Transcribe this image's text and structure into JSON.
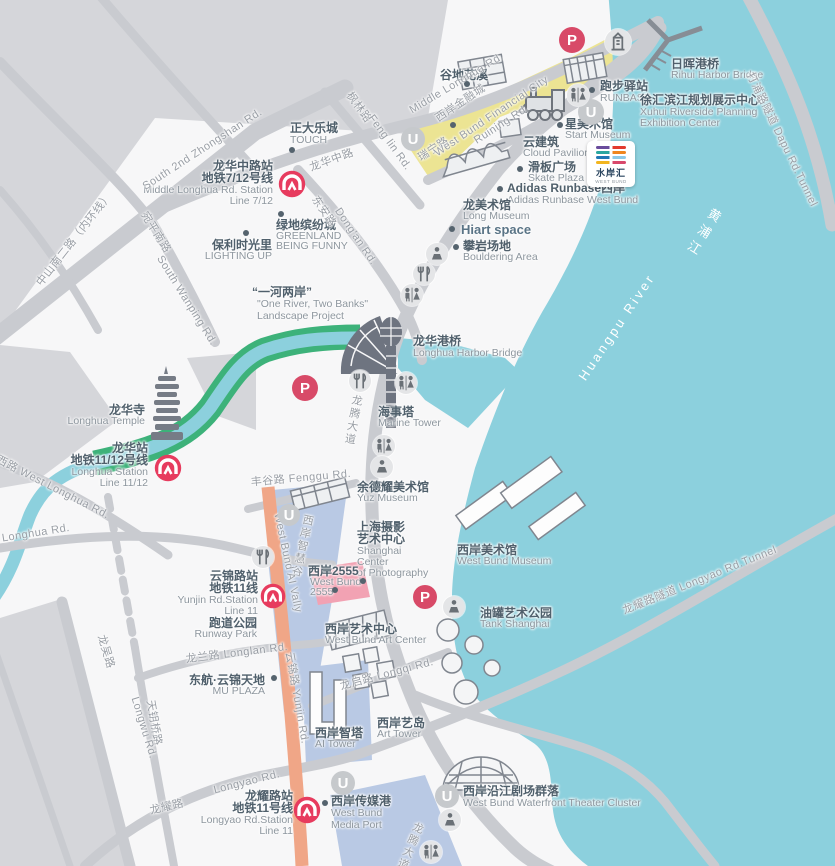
{
  "colors": {
    "water": "#8cd0dd",
    "block": "#d5d6da",
    "road": "#c9cbd0",
    "land": "#f7f7f8",
    "yellow_zone": "#ece493",
    "blue_zone": "#b9c9e4",
    "pink_zone": "#f2a2b3",
    "orange_road": "#f0a687",
    "green_bank": "#3db27a",
    "metro_red": "#e73b5e",
    "parking_red": "#d84a68",
    "label_cn": "#50606c",
    "label_en": "#8d969e",
    "road_label": "#999ea5",
    "white": "#ffffff"
  },
  "glyphs": {
    "parking": "P",
    "underpass": "U"
  },
  "logo": {
    "cn": "水岸汇",
    "en": "WEST BUND"
  },
  "labels": [
    {
      "id": "station-middle-longhua-cn1",
      "t": "龙华中路站",
      "x": 273,
      "y": 160,
      "a": "r",
      "c": "cn"
    },
    {
      "id": "station-middle-longhua-cn2",
      "t": "地铁7/12号线",
      "x": 273,
      "y": 172,
      "a": "r",
      "c": "cn"
    },
    {
      "id": "station-middle-longhua-en1",
      "t": "Middle Longhua Rd. Station",
      "x": 273,
      "y": 185,
      "a": "r",
      "c": "en"
    },
    {
      "id": "station-middle-longhua-en2",
      "t": "Line 7/12",
      "x": 273,
      "y": 196,
      "a": "r",
      "c": "en"
    },
    {
      "id": "station-longhua-cn1",
      "t": "龙华站",
      "x": 148,
      "y": 442,
      "a": "r",
      "c": "cn"
    },
    {
      "id": "station-longhua-cn2",
      "t": "地铁11/12号线",
      "x": 148,
      "y": 454,
      "a": "r",
      "c": "cn"
    },
    {
      "id": "station-longhua-en1",
      "t": "Longhua Station",
      "x": 148,
      "y": 467,
      "a": "r",
      "c": "en"
    },
    {
      "id": "station-longhua-en2",
      "t": "Line 11/12",
      "x": 148,
      "y": 478,
      "a": "r",
      "c": "en"
    },
    {
      "id": "station-yunjin-cn1",
      "t": "云锦路站",
      "x": 258,
      "y": 570,
      "a": "r",
      "c": "cn"
    },
    {
      "id": "station-yunjin-cn2",
      "t": "地铁11线",
      "x": 258,
      "y": 582,
      "a": "r",
      "c": "cn"
    },
    {
      "id": "station-yunjin-en1",
      "t": "Yunjin Rd.Station",
      "x": 258,
      "y": 595,
      "a": "r",
      "c": "en"
    },
    {
      "id": "station-yunjin-en2",
      "t": "Line 11",
      "x": 258,
      "y": 606,
      "a": "r",
      "c": "en"
    },
    {
      "id": "station-longyao-cn1",
      "t": "龙耀路站",
      "x": 293,
      "y": 790,
      "a": "r",
      "c": "cn"
    },
    {
      "id": "station-longyao-cn2",
      "t": "地铁11号线",
      "x": 293,
      "y": 802,
      "a": "r",
      "c": "cn"
    },
    {
      "id": "station-longyao-en1",
      "t": "Longyao Rd.Station",
      "x": 293,
      "y": 815,
      "a": "r",
      "c": "en"
    },
    {
      "id": "station-longyao-en2",
      "t": "Line 11",
      "x": 293,
      "y": 826,
      "a": "r",
      "c": "en"
    },
    {
      "id": "poi-touch-cn",
      "t": "正大乐城",
      "x": 290,
      "y": 122,
      "a": "l",
      "c": "cn"
    },
    {
      "id": "poi-touch-en",
      "t": "TOUCH",
      "x": 290,
      "y": 135,
      "a": "l",
      "c": "en"
    },
    {
      "id": "poi-poly-cn",
      "t": "保利时光里",
      "x": 272,
      "y": 239,
      "a": "r",
      "c": "cn"
    },
    {
      "id": "poi-poly-en",
      "t": "LIGHTING UP",
      "x": 272,
      "y": 251,
      "a": "r",
      "c": "en"
    },
    {
      "id": "poi-greenland-cn",
      "t": "绿地缤纷城",
      "x": 276,
      "y": 219,
      "a": "l",
      "c": "cn"
    },
    {
      "id": "poi-greenland-en1",
      "t": "GREENLAND",
      "x": 276,
      "y": 231,
      "a": "l",
      "c": "en"
    },
    {
      "id": "poi-greenland-en2",
      "t": "BEING FUNNY",
      "x": 276,
      "y": 241,
      "a": "l",
      "c": "en"
    },
    {
      "id": "poi-gudi-cn",
      "t": "谷地花溪",
      "x": 440,
      "y": 69,
      "a": "l",
      "c": "cn"
    },
    {
      "id": "poi-runbase-cn",
      "t": "跑步驿站",
      "x": 600,
      "y": 80,
      "a": "l",
      "c": "cn"
    },
    {
      "id": "poi-runbase-en",
      "t": "RUNBASE",
      "x": 600,
      "y": 93,
      "a": "l",
      "c": "en"
    },
    {
      "id": "poi-start-cn",
      "t": "星美术馆",
      "x": 565,
      "y": 118,
      "a": "l",
      "c": "cn"
    },
    {
      "id": "poi-start-en",
      "t": "Start Museum",
      "x": 565,
      "y": 130,
      "a": "l",
      "c": "en"
    },
    {
      "id": "poi-cloud-cn",
      "t": "云建筑",
      "x": 523,
      "y": 136,
      "a": "l",
      "c": "cn"
    },
    {
      "id": "poi-cloud-en",
      "t": "Cloud Pavilion",
      "x": 523,
      "y": 148,
      "a": "l",
      "c": "en"
    },
    {
      "id": "poi-skate-cn",
      "t": "滑板广场",
      "x": 528,
      "y": 161,
      "a": "l",
      "c": "cn"
    },
    {
      "id": "poi-skate-en",
      "t": "Skate Plaza",
      "x": 528,
      "y": 173,
      "a": "l",
      "c": "en"
    },
    {
      "id": "poi-adidas-cn",
      "t": "Adidas Runbase西岸",
      "x": 507,
      "y": 182,
      "a": "l",
      "c": "cn"
    },
    {
      "id": "poi-adidas-en",
      "t": "Adidas Runbase West Bund",
      "x": 507,
      "y": 195,
      "a": "l",
      "c": "en"
    },
    {
      "id": "poi-longmuseum-cn",
      "t": "龙美术馆",
      "x": 463,
      "y": 199,
      "a": "l",
      "c": "cn"
    },
    {
      "id": "poi-longmuseum-en",
      "t": "Long Museum",
      "x": 463,
      "y": 211,
      "a": "l",
      "c": "en"
    },
    {
      "id": "poi-hiart",
      "t": "Hiart space",
      "x": 461,
      "y": 223,
      "a": "l",
      "c": "cnb"
    },
    {
      "id": "poi-bouldering-cn",
      "t": "攀岩场地",
      "x": 463,
      "y": 240,
      "a": "l",
      "c": "cn"
    },
    {
      "id": "poi-bouldering-en",
      "t": "Bouldering Area",
      "x": 463,
      "y": 252,
      "a": "l",
      "c": "en"
    },
    {
      "id": "poi-rihui-cn",
      "t": "日晖港桥",
      "x": 671,
      "y": 58,
      "a": "l",
      "c": "cn"
    },
    {
      "id": "poi-rihui-en",
      "t": "Rihui Harbor Bridge",
      "x": 671,
      "y": 70,
      "a": "l",
      "c": "en"
    },
    {
      "id": "poi-exhibition-cn",
      "t": "徐汇滨江规划展示中心",
      "x": 640,
      "y": 94,
      "a": "l",
      "c": "cn"
    },
    {
      "id": "poi-exhibition-en1",
      "t": "Xuhui Riverside Planning",
      "x": 640,
      "y": 107,
      "a": "l",
      "c": "en"
    },
    {
      "id": "poi-exhibition-en2",
      "t": "Exhibition Center",
      "x": 640,
      "y": 118,
      "a": "l",
      "c": "en"
    },
    {
      "id": "poi-oneriver-cn",
      "t": "“一河两岸”",
      "x": 252,
      "y": 286,
      "a": "l",
      "c": "cn"
    },
    {
      "id": "poi-oneriver-en1",
      "t": "\"One River, Two Banks\"",
      "x": 257,
      "y": 299,
      "a": "l",
      "c": "en"
    },
    {
      "id": "poi-oneriver-en2",
      "t": "Landscape Project",
      "x": 257,
      "y": 311,
      "a": "l",
      "c": "en"
    },
    {
      "id": "poi-longhua-bridge-cn",
      "t": "龙华港桥",
      "x": 413,
      "y": 335,
      "a": "l",
      "c": "cn"
    },
    {
      "id": "poi-longhua-bridge-en",
      "t": "Longhua Harbor Bridge",
      "x": 413,
      "y": 348,
      "a": "l",
      "c": "en"
    },
    {
      "id": "poi-marine-cn",
      "t": "海事塔",
      "x": 378,
      "y": 406,
      "a": "l",
      "c": "cn"
    },
    {
      "id": "poi-marine-en",
      "t": "Marine Tower",
      "x": 378,
      "y": 418,
      "a": "l",
      "c": "en"
    },
    {
      "id": "poi-temple-cn",
      "t": "龙华寺",
      "x": 145,
      "y": 404,
      "a": "r",
      "c": "cn"
    },
    {
      "id": "poi-temple-en",
      "t": "Longhua Temple",
      "x": 145,
      "y": 416,
      "a": "r",
      "c": "en"
    },
    {
      "id": "poi-yuz-cn",
      "t": "余德耀美术馆",
      "x": 357,
      "y": 481,
      "a": "l",
      "c": "cn"
    },
    {
      "id": "poi-yuz-en",
      "t": "Yuz Museum",
      "x": 357,
      "y": 493,
      "a": "l",
      "c": "en"
    },
    {
      "id": "poi-scop-cn1",
      "t": "上海摄影",
      "x": 357,
      "y": 521,
      "a": "l",
      "c": "cn"
    },
    {
      "id": "poi-scop-cn2",
      "t": "艺术中心",
      "x": 357,
      "y": 533,
      "a": "l",
      "c": "cn"
    },
    {
      "id": "poi-scop-en1",
      "t": "Shanghai",
      "x": 357,
      "y": 546,
      "a": "l",
      "c": "en"
    },
    {
      "id": "poi-scop-en2",
      "t": "Center",
      "x": 357,
      "y": 557,
      "a": "l",
      "c": "en"
    },
    {
      "id": "poi-scop-en3",
      "t": "of Photography",
      "x": 357,
      "y": 568,
      "a": "l",
      "c": "en"
    },
    {
      "id": "poi-2555-cn",
      "t": "西岸2555",
      "x": 308,
      "y": 565,
      "a": "l",
      "c": "cn"
    },
    {
      "id": "poi-2555-en1",
      "t": "West Bund",
      "x": 310,
      "y": 577,
      "a": "l",
      "c": "en"
    },
    {
      "id": "poi-2555-en2",
      "t": "2555",
      "x": 310,
      "y": 587,
      "a": "l",
      "c": "en"
    },
    {
      "id": "poi-wbmuseum-cn",
      "t": "西岸美术馆",
      "x": 457,
      "y": 544,
      "a": "l",
      "c": "cn"
    },
    {
      "id": "poi-wbmuseum-en",
      "t": "West Bund Museum",
      "x": 457,
      "y": 556,
      "a": "l",
      "c": "en"
    },
    {
      "id": "poi-tank-cn",
      "t": "油罐艺术公园",
      "x": 480,
      "y": 607,
      "a": "l",
      "c": "cn"
    },
    {
      "id": "poi-tank-en",
      "t": "Tank Shanghai",
      "x": 480,
      "y": 619,
      "a": "l",
      "c": "en"
    },
    {
      "id": "poi-runway-cn",
      "t": "跑道公园",
      "x": 257,
      "y": 617,
      "a": "r",
      "c": "cn"
    },
    {
      "id": "poi-runway-en",
      "t": "Runway Park",
      "x": 257,
      "y": 629,
      "a": "r",
      "c": "en"
    },
    {
      "id": "poi-mu-cn",
      "t": "东航·云锦天地",
      "x": 265,
      "y": 674,
      "a": "r",
      "c": "cn"
    },
    {
      "id": "poi-mu-en",
      "t": "MU PLAZA",
      "x": 265,
      "y": 686,
      "a": "r",
      "c": "en"
    },
    {
      "id": "poi-artcenter-cn",
      "t": "西岸艺术中心",
      "x": 325,
      "y": 623,
      "a": "l",
      "c": "cn"
    },
    {
      "id": "poi-artcenter-en",
      "t": "West Bund Art Center",
      "x": 325,
      "y": 635,
      "a": "l",
      "c": "en"
    },
    {
      "id": "poi-aitower-cn",
      "t": "西岸智塔",
      "x": 315,
      "y": 727,
      "a": "l",
      "c": "cn"
    },
    {
      "id": "poi-aitower-en",
      "t": "AI Tower",
      "x": 315,
      "y": 739,
      "a": "l",
      "c": "en"
    },
    {
      "id": "poi-arttower-cn",
      "t": "西岸艺岛",
      "x": 377,
      "y": 717,
      "a": "l",
      "c": "cn"
    },
    {
      "id": "poi-arttower-en",
      "t": "Art Tower",
      "x": 377,
      "y": 729,
      "a": "l",
      "c": "en"
    },
    {
      "id": "poi-mediaport-cn",
      "t": "西岸传媒港",
      "x": 331,
      "y": 795,
      "a": "l",
      "c": "cn"
    },
    {
      "id": "poi-mediaport-en1",
      "t": "West Bund",
      "x": 331,
      "y": 808,
      "a": "l",
      "c": "en"
    },
    {
      "id": "poi-mediaport-en2",
      "t": "Media Port",
      "x": 331,
      "y": 820,
      "a": "l",
      "c": "en"
    },
    {
      "id": "poi-theater-cn",
      "t": "西岸沿江剧场群落",
      "x": 463,
      "y": 785,
      "a": "l",
      "c": "cn"
    },
    {
      "id": "poi-theater-en",
      "t": "West Bund Waterfront Theater Cluster",
      "x": 463,
      "y": 798,
      "a": "l",
      "c": "en"
    },
    {
      "id": "road-zhongshan-cn",
      "t": "中山南二路（内环线）",
      "x": 75,
      "y": 240,
      "a": "c",
      "c": "rd",
      "r": -52
    },
    {
      "id": "road-zhongshan-en",
      "t": "South 2nd Zhongshan Rd.",
      "x": 203,
      "y": 150,
      "a": "c",
      "c": "rd",
      "r": -33
    },
    {
      "id": "road-wanping-cn",
      "t": "宛平南路",
      "x": 155,
      "y": 233,
      "a": "c",
      "c": "rd",
      "r": 58
    },
    {
      "id": "road-wanping-en",
      "t": "South Wanping Rd.",
      "x": 186,
      "y": 301,
      "a": "c",
      "c": "rd",
      "r": 58
    },
    {
      "id": "road-middle-longhua-cn",
      "t": "龙华中路",
      "x": 332,
      "y": 161,
      "a": "c",
      "c": "rd",
      "r": -20
    },
    {
      "id": "road-middle-longhua-en",
      "t": "Middle Longhua Rd.",
      "x": 457,
      "y": 84,
      "a": "c",
      "c": "rd",
      "r": -31
    },
    {
      "id": "road-fenglin-cn",
      "t": "枫林路",
      "x": 358,
      "y": 108,
      "a": "c",
      "c": "rd",
      "r": 54
    },
    {
      "id": "road-fenglin-en",
      "t": "Feng lin Rd.",
      "x": 389,
      "y": 143,
      "a": "c",
      "c": "rd",
      "r": 54
    },
    {
      "id": "road-dongan-cn",
      "t": "东安路",
      "x": 323,
      "y": 212,
      "a": "c",
      "c": "rd",
      "r": 56
    },
    {
      "id": "road-dongan-en",
      "t": "Dong'an Rd.",
      "x": 355,
      "y": 237,
      "a": "c",
      "c": "rd",
      "r": 56
    },
    {
      "id": "road-ruining-cn",
      "t": "瑞宁路",
      "x": 434,
      "y": 150,
      "a": "c",
      "c": "rd",
      "r": -33
    },
    {
      "id": "road-ruining-en",
      "t": "Ruining Rd.",
      "x": 502,
      "y": 125,
      "a": "c",
      "c": "rd",
      "r": -33
    },
    {
      "id": "zone-financial-cn",
      "t": "西岸金融城",
      "x": 461,
      "y": 104,
      "a": "c",
      "c": "rd",
      "r": -34
    },
    {
      "id": "zone-financial-en",
      "t": "West Bund Financial City",
      "x": 492,
      "y": 117,
      "a": "c",
      "c": "rd",
      "r": -34
    },
    {
      "id": "road-longteng-1",
      "t": "龙腾大道",
      "x": 352,
      "y": 420,
      "a": "c",
      "c": "rdv",
      "r": 10
    },
    {
      "id": "road-longteng-2",
      "t": "龙腾大道",
      "x": 409,
      "y": 846,
      "a": "c",
      "c": "rdv",
      "r": 22
    },
    {
      "id": "road-fenggu",
      "t": "丰谷路  Fenggu Rd.",
      "x": 301,
      "y": 479,
      "a": "c",
      "c": "rd",
      "r": -5
    },
    {
      "id": "road-west-longhua",
      "t": "龙华西路  West Longhua Rd.",
      "x": 42,
      "y": 483,
      "a": "c",
      "c": "rd",
      "r": 27
    },
    {
      "id": "road-longhua",
      "t": "Longhua Rd.",
      "x": 36,
      "y": 534,
      "a": "c",
      "c": "rd",
      "r": -9
    },
    {
      "id": "road-longlan",
      "t": "龙兰路  Longlan Rd.",
      "x": 237,
      "y": 654,
      "a": "c",
      "c": "rd",
      "r": -7
    },
    {
      "id": "road-yunjin",
      "t": "云锦路  Yunjin Rd.",
      "x": 296,
      "y": 698,
      "a": "c",
      "c": "rd",
      "r": 80
    },
    {
      "id": "road-tianyaoqiao",
      "t": "天钥桥路",
      "x": 153,
      "y": 723,
      "a": "c",
      "c": "rd",
      "r": 80
    },
    {
      "id": "road-longwu-cn",
      "t": "龙吴路",
      "x": 105,
      "y": 652,
      "a": "c",
      "c": "rd",
      "r": 73
    },
    {
      "id": "road-longwu-en",
      "t": "Longwu Rd.",
      "x": 143,
      "y": 728,
      "a": "c",
      "c": "rd",
      "r": 73
    },
    {
      "id": "road-longyao-cn",
      "t": "龙耀路",
      "x": 167,
      "y": 808,
      "a": "c",
      "c": "rd",
      "r": -13
    },
    {
      "id": "road-longyao-en",
      "t": "Longyao Rd.",
      "x": 247,
      "y": 783,
      "a": "c",
      "c": "rd",
      "r": -14
    },
    {
      "id": "road-longqi",
      "t": "龙启路  Longqi Rd.",
      "x": 387,
      "y": 675,
      "a": "c",
      "c": "rd",
      "r": -15
    },
    {
      "id": "road-longyao-tunnel",
      "t": "龙耀路隧道  Longyao Rd.Tunnel",
      "x": 700,
      "y": 581,
      "a": "c",
      "c": "rd",
      "r": -22
    },
    {
      "id": "road-dapu-tunnel",
      "t": "打浦路隧道  Dapu Rd.Tunnel",
      "x": 781,
      "y": 140,
      "a": "c",
      "c": "rd",
      "r": 64
    },
    {
      "id": "zone-aivally-cn",
      "t": "西岸智慧谷",
      "x": 301,
      "y": 546,
      "a": "c",
      "c": "rdv",
      "r": 12
    },
    {
      "id": "zone-aivally-en",
      "t": "West Bund AI Vally",
      "x": 287,
      "y": 563,
      "a": "c",
      "c": "rd",
      "r": 78
    },
    {
      "id": "river-cn",
      "t": "黄浦江",
      "x": 702,
      "y": 233,
      "a": "c",
      "c": "wtv",
      "r": 32
    },
    {
      "id": "river-en",
      "t": "Huangpu River",
      "x": 617,
      "y": 327,
      "a": "c",
      "c": "wt",
      "r": -56
    }
  ],
  "markers": [
    {
      "type": "metro",
      "x": 292,
      "y": 184,
      "r": 14
    },
    {
      "type": "metro",
      "x": 168,
      "y": 468,
      "r": 14
    },
    {
      "type": "metro",
      "x": 273,
      "y": 596,
      "r": 13
    },
    {
      "type": "metro",
      "x": 307,
      "y": 810,
      "r": 14
    },
    {
      "type": "parking",
      "x": 572,
      "y": 40,
      "r": 13
    },
    {
      "type": "parking",
      "x": 305,
      "y": 388,
      "r": 13
    },
    {
      "type": "parking",
      "x": 425,
      "y": 597,
      "r": 12
    },
    {
      "type": "underpass",
      "x": 413,
      "y": 139,
      "r": 12
    },
    {
      "type": "underpass",
      "x": 591,
      "y": 112,
      "r": 13
    },
    {
      "type": "underpass",
      "x": 289,
      "y": 515,
      "r": 11
    },
    {
      "type": "underpass",
      "x": 343,
      "y": 783,
      "r": 12
    },
    {
      "type": "underpass",
      "x": 447,
      "y": 796,
      "r": 12
    },
    {
      "type": "restroom",
      "x": 578,
      "y": 95,
      "r": 11
    },
    {
      "type": "restroom",
      "x": 412,
      "y": 295,
      "r": 11
    },
    {
      "type": "restroom",
      "x": 406,
      "y": 383,
      "r": 11
    },
    {
      "type": "restroom",
      "x": 384,
      "y": 446,
      "r": 11
    },
    {
      "type": "restroom",
      "x": 431,
      "y": 852,
      "r": 11
    },
    {
      "type": "restaurant",
      "x": 424,
      "y": 274,
      "r": 11
    },
    {
      "type": "restaurant",
      "x": 360,
      "y": 381,
      "r": 11
    },
    {
      "type": "restaurant",
      "x": 263,
      "y": 557,
      "r": 11
    },
    {
      "type": "viewpoint",
      "x": 437,
      "y": 254,
      "r": 11
    },
    {
      "type": "viewpoint",
      "x": 382,
      "y": 467,
      "r": 11
    },
    {
      "type": "viewpoint",
      "x": 454,
      "y": 607,
      "r": 11
    },
    {
      "type": "viewpoint",
      "x": 450,
      "y": 820,
      "r": 11
    },
    {
      "type": "buildingicon",
      "x": 618,
      "y": 42,
      "r": 13
    },
    {
      "type": "dot",
      "x": 292,
      "y": 150,
      "r": 3
    },
    {
      "type": "dot",
      "x": 246,
      "y": 233,
      "r": 3
    },
    {
      "type": "dot",
      "x": 281,
      "y": 214,
      "r": 3
    },
    {
      "type": "dot",
      "x": 467,
      "y": 84,
      "r": 3
    },
    {
      "type": "dot",
      "x": 592,
      "y": 90,
      "r": 3
    },
    {
      "type": "dot",
      "x": 560,
      "y": 125,
      "r": 3
    },
    {
      "type": "dot",
      "x": 520,
      "y": 169,
      "r": 3
    },
    {
      "type": "dot",
      "x": 500,
      "y": 189,
      "r": 3
    },
    {
      "type": "dot",
      "x": 452,
      "y": 229,
      "r": 3
    },
    {
      "type": "dot",
      "x": 456,
      "y": 247,
      "r": 3
    },
    {
      "type": "dot",
      "x": 274,
      "y": 678,
      "r": 3
    },
    {
      "type": "dot",
      "x": 325,
      "y": 803,
      "r": 3
    },
    {
      "type": "dot",
      "x": 335,
      "y": 590,
      "r": 3
    },
    {
      "type": "dot",
      "x": 363,
      "y": 581,
      "r": 3
    },
    {
      "type": "dot",
      "x": 453,
      "y": 125,
      "r": 3
    }
  ]
}
